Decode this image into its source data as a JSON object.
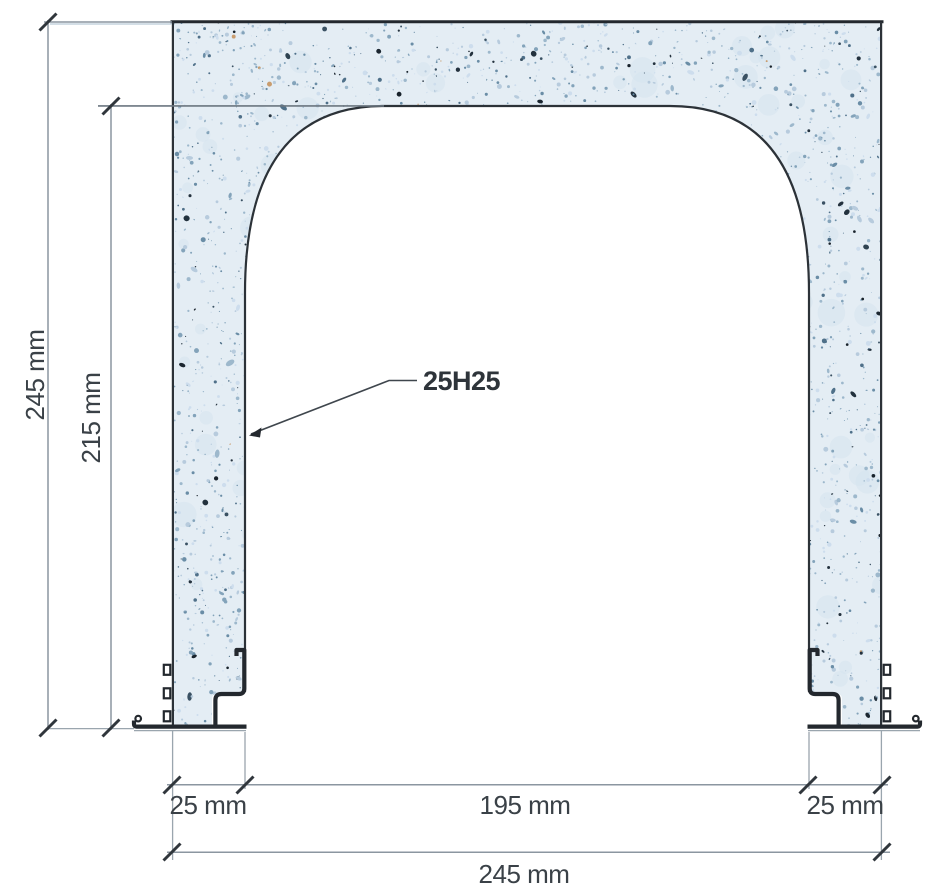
{
  "diagram": {
    "type": "reinforced concrete portal cross-section",
    "rebar_label": "25H25",
    "dimensions": {
      "overall_height": "245 mm",
      "opening_height": "215 mm",
      "left_wall": "25 mm",
      "opening_width": "195 mm",
      "right_wall": "25 mm",
      "overall_width": "245 mm"
    },
    "colors": {
      "concrete_fill": "#e4edf4",
      "speckle_dark": "#24323e",
      "speckle_mid": "#83a3ba",
      "outline": "#23282e",
      "dimension_line": "#8b96a0",
      "label_text": "#3a4147"
    }
  }
}
